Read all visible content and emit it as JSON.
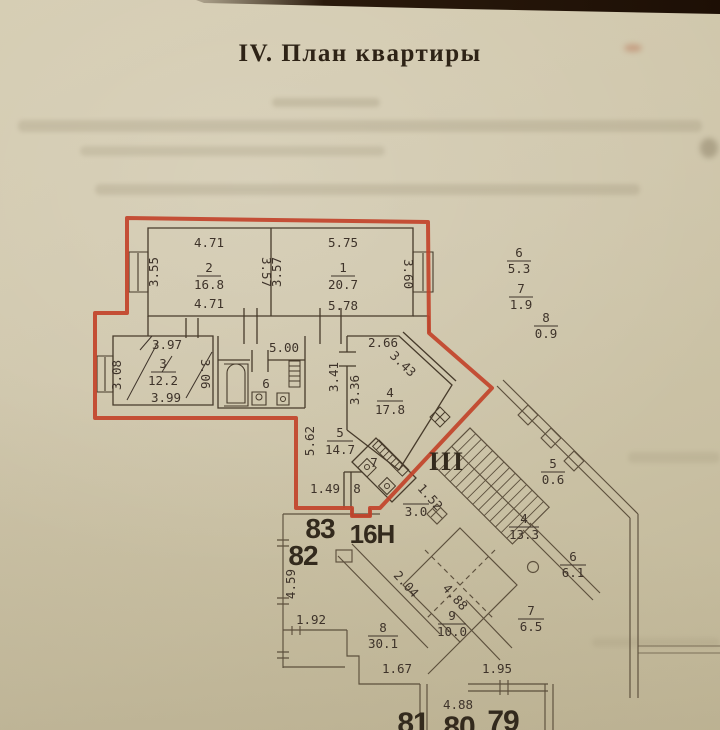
{
  "title": "IV. План квартиры",
  "colors": {
    "paper": "#cfc6ab",
    "ink": "#43382a",
    "red": "#c2432a"
  },
  "plan": {
    "apartment": {
      "corridor_dim": "5.00",
      "entry_dim": "1.49",
      "rooms": [
        {
          "number": "1",
          "area": "20.7",
          "dim_top": "5.75",
          "dim_left": "3.57",
          "dim_right": "3.60",
          "dim_bottom": "5.78"
        },
        {
          "number": "2",
          "area": "16.8",
          "dim_top": "4.71",
          "dim_left": "3.55",
          "dim_right": "3.57",
          "dim_bottom": "4.71"
        },
        {
          "number": "3",
          "area": "12.2",
          "dim_top": "3.97",
          "dim_left": "3.08",
          "dim_right": "3.06",
          "dim_bottom": "3.99"
        },
        {
          "number": "4",
          "area": "17.8",
          "dim_top": "2.66",
          "dim_left_upper": "3.41",
          "dim_left_lower": "3.36",
          "dim_diagonal": "3.43"
        },
        {
          "number": "5",
          "area": "14.7",
          "dim_side": "5.62"
        },
        {
          "number": "6",
          "area": "5.3",
          "plan_label": "6"
        },
        {
          "number": "7",
          "area": "1.9",
          "plan_label": "7"
        },
        {
          "number": "8",
          "area": "0.9",
          "plan_label": "8"
        }
      ]
    },
    "stairwell": {
      "section": "III",
      "spaces": [
        {
          "number": "5",
          "area": "0.6"
        },
        {
          "number": "4",
          "area": "13.3"
        },
        {
          "number": "6",
          "area": "6.1"
        },
        {
          "number": "7",
          "area": "6.5"
        },
        {
          "number": "9",
          "area": "10.0"
        },
        {
          "number": "8",
          "area": "30.1"
        }
      ],
      "dims": {
        "landing_w": "1.52",
        "landing_l": "3.0",
        "corr_w": "2.04",
        "corr_l": "4.88",
        "wall_left": "4.59",
        "seg_1": "1.92",
        "seg_2": "1.67",
        "seg_3": "1.95",
        "seg_4": "4.88"
      }
    },
    "units": [
      "83",
      "16Н",
      "82",
      "81",
      "80",
      "79"
    ]
  }
}
